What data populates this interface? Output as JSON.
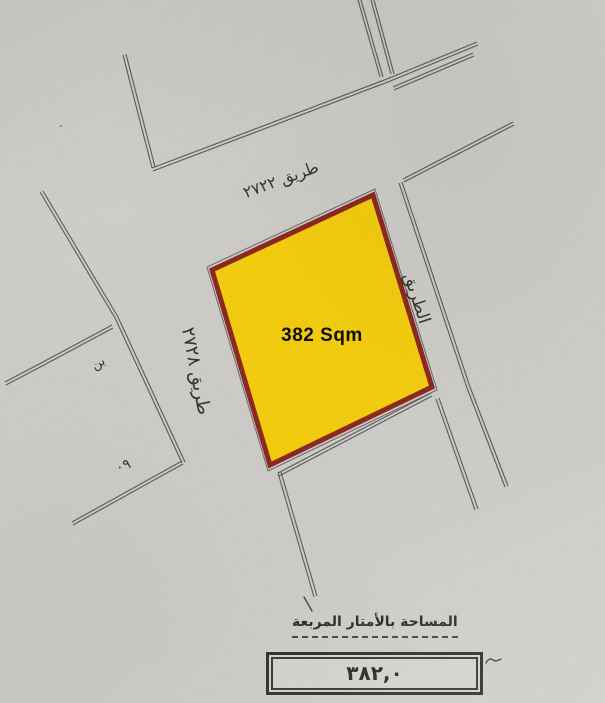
{
  "plot": {
    "area_label": "382 Sqm"
  },
  "roads": {
    "top_label": "طريق ٢٧٢٢",
    "left_label": "طريق ٢٧٢٨",
    "right_label": "الطريق"
  },
  "marks": {
    "note_small": "بن",
    "note_number": "٠٩"
  },
  "footer": {
    "title": "المساحة بالأمتار المربعة",
    "area_value": "٣٨٢,٠"
  },
  "colors": {
    "paper": "#d5d3d0",
    "plot_fill": "#ffd400",
    "plot_border": "#8d1d12",
    "line": "#56544f",
    "ink": "#36342f"
  }
}
